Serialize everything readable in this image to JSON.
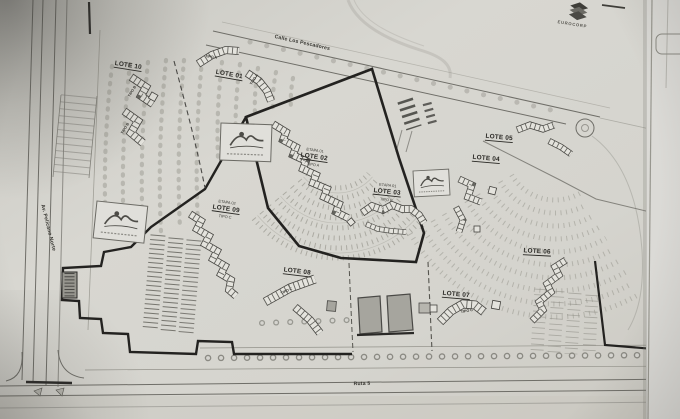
{
  "plan": {
    "streets": {
      "top": "Calle Los Pescadores",
      "left": "Av. Pelícano Norte",
      "bottom": "Ruta 5"
    },
    "corner_brand": "EUROCORP",
    "stages": {
      "etapa01": "ETAPA 01",
      "etapa02": "ETAPA 02"
    },
    "types": {
      "tipo_a": "TIPO A",
      "tipo_b": "TIPO B",
      "tipo_c": "TIPO C"
    },
    "lots": {
      "lote01": "LOTE 01",
      "lote02": "LOTE 02",
      "lote03": "LOTE 03",
      "lote04": "LOTE 04",
      "lote05": "LOTE 05",
      "lote06": "LOTE 06",
      "lote07": "LOTE 07",
      "lote08": "LOTE 08",
      "lote09": "LOTE 09",
      "lote10": "LOTE 10"
    }
  }
}
